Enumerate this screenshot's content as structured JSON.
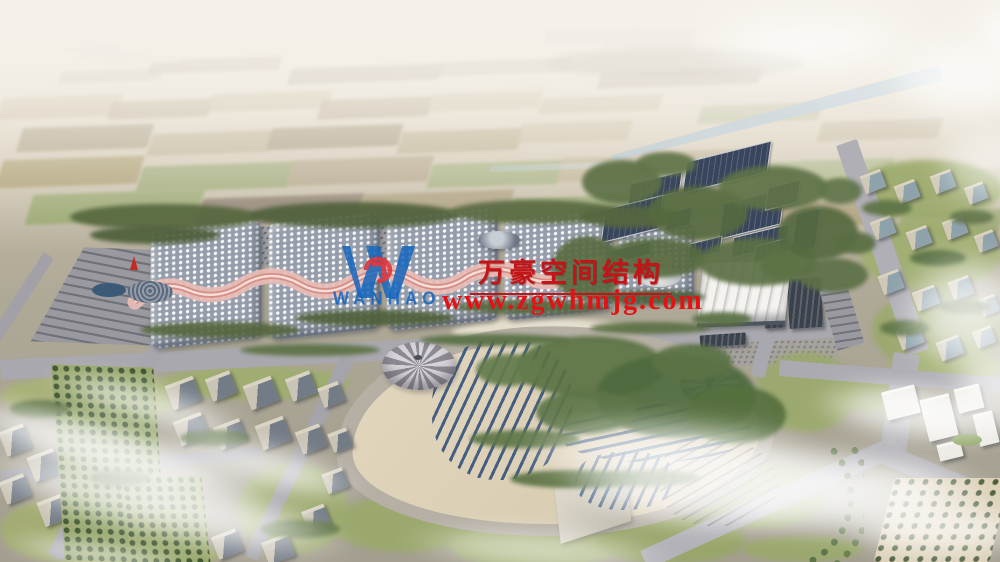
{
  "watermark": {
    "logo": {
      "monogram": "W",
      "wordmark": "WANHAO",
      "blue": "#1565bd",
      "red": "#e03236"
    },
    "title": "万豪空间结构",
    "title_color": "#c51418",
    "url": "www.zgwhmjg.com",
    "url_color": "#e41215"
  }
}
